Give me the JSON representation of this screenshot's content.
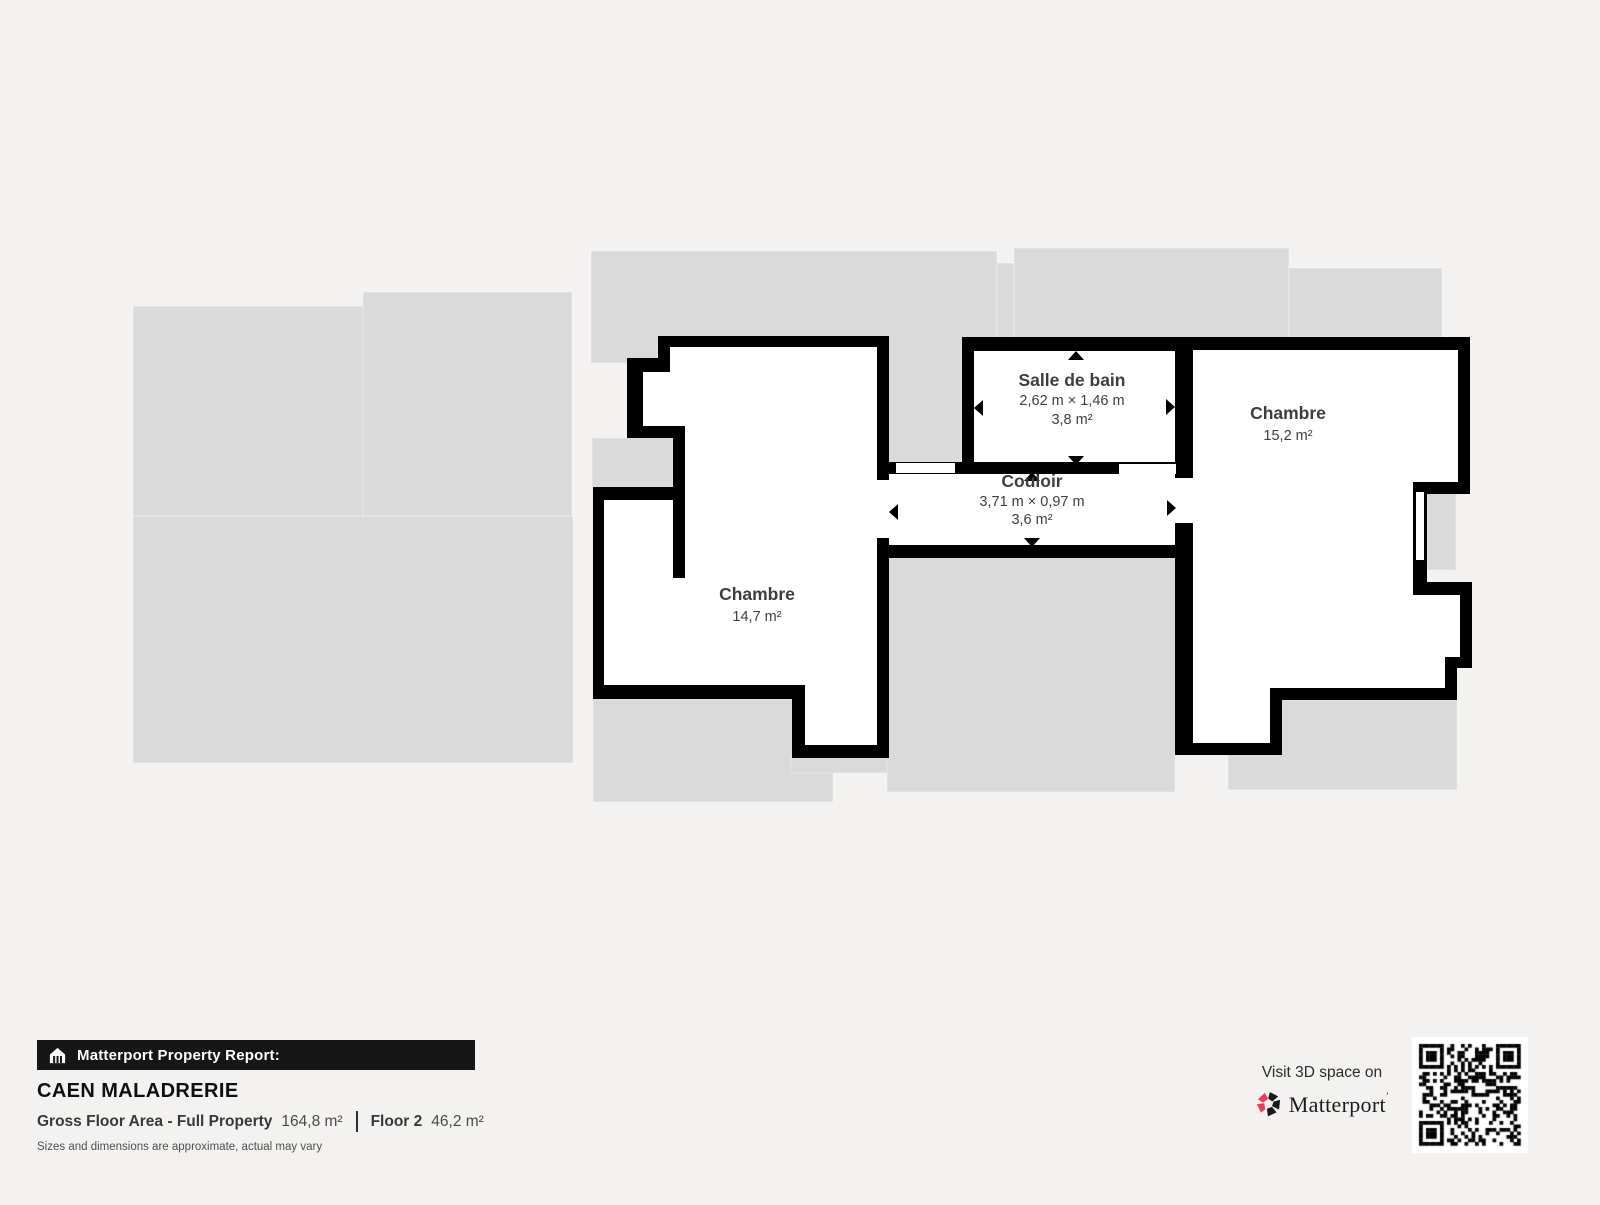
{
  "plan": {
    "rooms": [
      {
        "id": "chambre-left",
        "name": "Chambre",
        "area": "14,7 m²"
      },
      {
        "id": "salle-de-bain",
        "name": "Salle de bain",
        "dimensions": "2,62 m × 1,46 m",
        "area": "3,8 m²"
      },
      {
        "id": "couloir",
        "name": "Couloir",
        "dimensions": "3,71 m × 0,97 m",
        "area": "3,6 m²"
      },
      {
        "id": "chambre-right",
        "name": "Chambre",
        "area": "15,2 m²"
      }
    ]
  },
  "footer": {
    "report_label": "Matterport Property Report:",
    "property_name": "CAEN MALADRERIE",
    "gfa_label": "Gross Floor Area - Full Property",
    "gfa_value": "164,8 m²",
    "floor_label": "Floor 2",
    "floor_value": "46,2 m²",
    "disclaimer": "Sizes and dimensions are approximate, actual may vary"
  },
  "cta": {
    "visit_label": "Visit 3D space on",
    "brand": "Matterport"
  },
  "icons": {
    "house": "house-icon",
    "pinwheel": "matterport-logo-icon",
    "qr": "qr-code"
  },
  "colors": {
    "background": "#f3f2f0",
    "inactive_floor": "#dadada",
    "wall": "#000000",
    "room_interior": "#ffffff",
    "room_text": "#3e3e3e",
    "brand_pink": "#ef3c5f",
    "bar_background": "#161616"
  }
}
